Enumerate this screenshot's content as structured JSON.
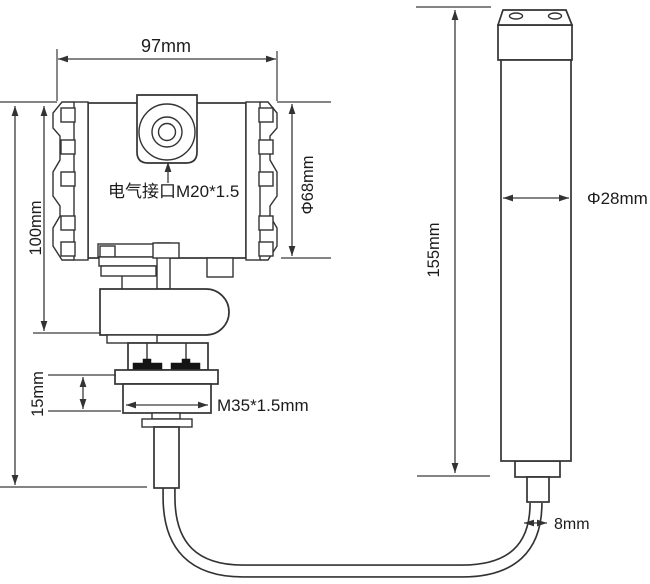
{
  "drawing": {
    "kind": "technical-dimension-drawing",
    "labels": {
      "head_width": "97mm",
      "head_height": "100mm",
      "gland_height": "15mm",
      "electrical_port": "电气接口M20*1.5",
      "head_diameter": "Φ68mm",
      "process_thread": "M35*1.5mm",
      "probe_length": "155mm",
      "probe_diameter": "Φ28mm",
      "cable_diameter": "8mm"
    },
    "colors": {
      "line": "#333333",
      "text": "#1c1c1c",
      "background": "#ffffff",
      "bolt": "#141414"
    }
  }
}
